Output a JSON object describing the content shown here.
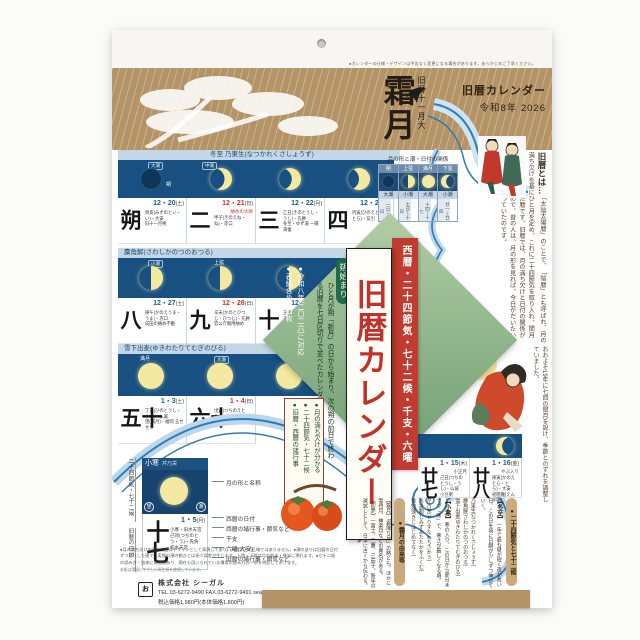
{
  "header": {
    "note": "●カレンダーの仕様・デザインは予告なく変更になる場合があります。あらかじめご了承ください。",
    "month_main": "霜月",
    "month_sub": "旧暦十一月大",
    "brand": "旧暦カレンダー",
    "year": "令和8年 2026"
  },
  "moon_table": {
    "title": "月の形と潮・日付の関係",
    "cols": [
      {
        "phase": "朔",
        "tide": "大潮",
        "days": "一日〜三日"
      },
      {
        "phase": "上弦",
        "tide": "小潮",
        "days": "七日〜十日"
      },
      {
        "phase": "満月",
        "tide": "大潮",
        "days": "十四〜十七"
      },
      {
        "phase": "下弦",
        "tide": "小潮",
        "days": "廿一〜廿四"
      }
    ]
  },
  "about": {
    "lead": "旧暦とは…",
    "body": "「太陰太陽暦」のことで、「陰暦」とも呼ばれ、月の満ち欠けを基にひと月を定め、これに二十四節気を取り入れ、閏月を設けて調整した暦です。旧暦では、月の満ち欠けと日付の関係がひと目でわかるので、昔の人は、月の形を見れば、今日がだいたい何日なのかを知っていたのです。",
    "body2": "おおよそ19年に七回の閏月を設け、季節とのずれを調整していました。"
  },
  "rows": [
    {
      "label": "冬至 乃東生(なつかれくさしょうず)",
      "tides": [
        "大潮",
        "中潮"
      ],
      "moon_label": "朔",
      "days": [
        {
          "num": "朔",
          "date": "12・20",
          "dow": "(土)",
          "note1": "癸亥(みずのとい・い)・大安",
          "note2": "旧十一月朔"
        },
        {
          "num": "二",
          "date": "12・21",
          "dow": "(日)",
          "tag": "納めの大師",
          "note1": "甲子(きのえね・ね)・赤口",
          "note2": ""
        },
        {
          "num": "三",
          "date": "12・22",
          "dow": "(月)",
          "note1": "乙丑(きのとうし・うし)・先勝",
          "note2": "冬至・ゆず湯 一陽来復"
        },
        {
          "num": "四",
          "date": "12・23",
          "dow": "(火)",
          "note1": "丙寅(ひのえとら・とら)・友引",
          "note2": ""
        }
      ]
    },
    {
      "label": "麋角解(さわしかのつのおつる)",
      "tides": [
        "小潮"
      ],
      "moon_label": "上弦",
      "days": [
        {
          "num": "八",
          "date": "12・27",
          "dow": "(土)",
          "note1": "庚午(かのえうま・うま)・赤口",
          "note2": "成田の納め不動"
        },
        {
          "num": "九",
          "date": "12・28",
          "dow": "(日)",
          "note1": "辛未(かのとひつじ・ひつじ)・先勝",
          "note2": "官公庁御用納め"
        },
        {
          "num": "十",
          "date": "12・29",
          "dow": "(月)",
          "note1": "壬申(みずのえさる・さる)・友引",
          "note2": ""
        }
      ]
    },
    {
      "label": "雪下出麦(ゆきわたりてむぎのびる)",
      "tides": [
        "大潮"
      ],
      "moon_label": "満月",
      "days": [
        {
          "num": "十五",
          "date": "1・3",
          "dow": "(土)",
          "note1": "丁丑(ひのとうし・うし)・仏滅",
          "note2": "望(満月)・福岡 玉せせり"
        },
        {
          "num": "十六",
          "date": "1・4",
          "dow": "(日)",
          "note1": "戊寅(つちのえとら・とら)・大安",
          "note2": "官公庁御用始め"
        }
      ]
    },
    {
      "label": "",
      "days": [
        {
          "num": "廿七",
          "date": "1・15",
          "dow": "(木)",
          "tag": "小正月",
          "note1": "己丑(つちのとうし・うし)・仏滅",
          "note2": "小豆粥"
        },
        {
          "num": "廿八",
          "date": "1・16",
          "dow": "(金)",
          "tag": "やぶ入り",
          "note1": "庚寅(かのえとら・とら)・大安",
          "note2": "初閻魔(えんま詣)"
        }
      ]
    }
  ],
  "sample": {
    "header": "小寒",
    "header_sub": "芹乃栄",
    "corner_left": "望",
    "corner_right": "潮",
    "kyureki_day": "十七",
    "date": "1・5",
    "dow": "(月)",
    "line1": "小寒・旧水天宮",
    "line2": "己卯(つちのとう・う)・先負",
    "line3": "初水天宮",
    "annotations": [
      "月の形と名称",
      "西暦の日付",
      "西暦の諸行事・節気など",
      "干支",
      "六曜(大安)",
      "旧暦の諸行事・節気など"
    ],
    "left_label1": "二十四節気・七十二候",
    "left_label2": "旧暦の日付"
  },
  "diamond": {
    "pill": "朔始まり",
    "desc": "ひと月が朔「新月」の日から始まり、次の朔の前日で終わる旧暦を七日区切りで並べたカレンダーです。",
    "bullet1": "●令和八年(二〇二六)に対応",
    "bullet2": "●表紙含め十四枚",
    "box1": "●月の満ち欠けが分かる",
    "box2": "●二十四節気・七十二候",
    "box3": "●旧暦・西暦の諸行事"
  },
  "banners": {
    "red": "西暦・二十四節気・七十二候・千支・六曜",
    "white": "旧暦カレンダー"
  },
  "sekki": {
    "pill1": "●二十四節気と七十二候",
    "e1_head": "【冬至】",
    "e1_body": "一年で最も昼が短く夜が長い日。この日を境に日脚が少しずつ伸びていく。",
    "e1_i1": "乃東生(なつかれくさしょうず)",
    "e1_i2": "麋角解(さわしかのつのおつる)",
    "e1_i3": "雪下出麦(ゆきわたりてむぎのびる)",
    "e2_head": "【小寒】",
    "e2_body": "寒の入り。この日から節分までが「寒」で、寒さが厳しくなる頃。",
    "e2_i1": "芹乃栄(せりすなわちさかう)",
    "e2_i2": "水泉動(しみずあたたかをふくむ)",
    "e2_i3": "雉始雊(きじはじめてなく)",
    "pill2": "●霜月の由来等",
    "yurai": "【霜月】「霜降り月」の略とも。ほかに雪待月、神楽月などの異名がある。",
    "misc": "【初夢】一富士、二鷹、三茄子。新年の運試しとして、日本に古くから伝わる。"
  },
  "footer": {
    "note1": "●月の満ち欠けの形や位置はデザインとして表現してあり、天文学上の正確ではありません。●潮の送りは旧暦の日付",
    "note2": "ずつ送りした値で、実際の潮の動きとは多少誤差が生じます。上弦・下弦は月の前半・後半に現れます。●七十二候",
    "note3": "の読み方・由来には諸説あり、現在も用いられている慣用の読み方の一例を明記しております。",
    "note4": "本紙は環境にやさしい再生紙を使用しています。",
    "mark": "お",
    "company": "株式会社 シーガル",
    "tel": "TEL.03-6272-9490 FAX.03-6272-9491  seagull-calendar.com",
    "price": "税込価格1,980円(本体価格1,800円)"
  }
}
